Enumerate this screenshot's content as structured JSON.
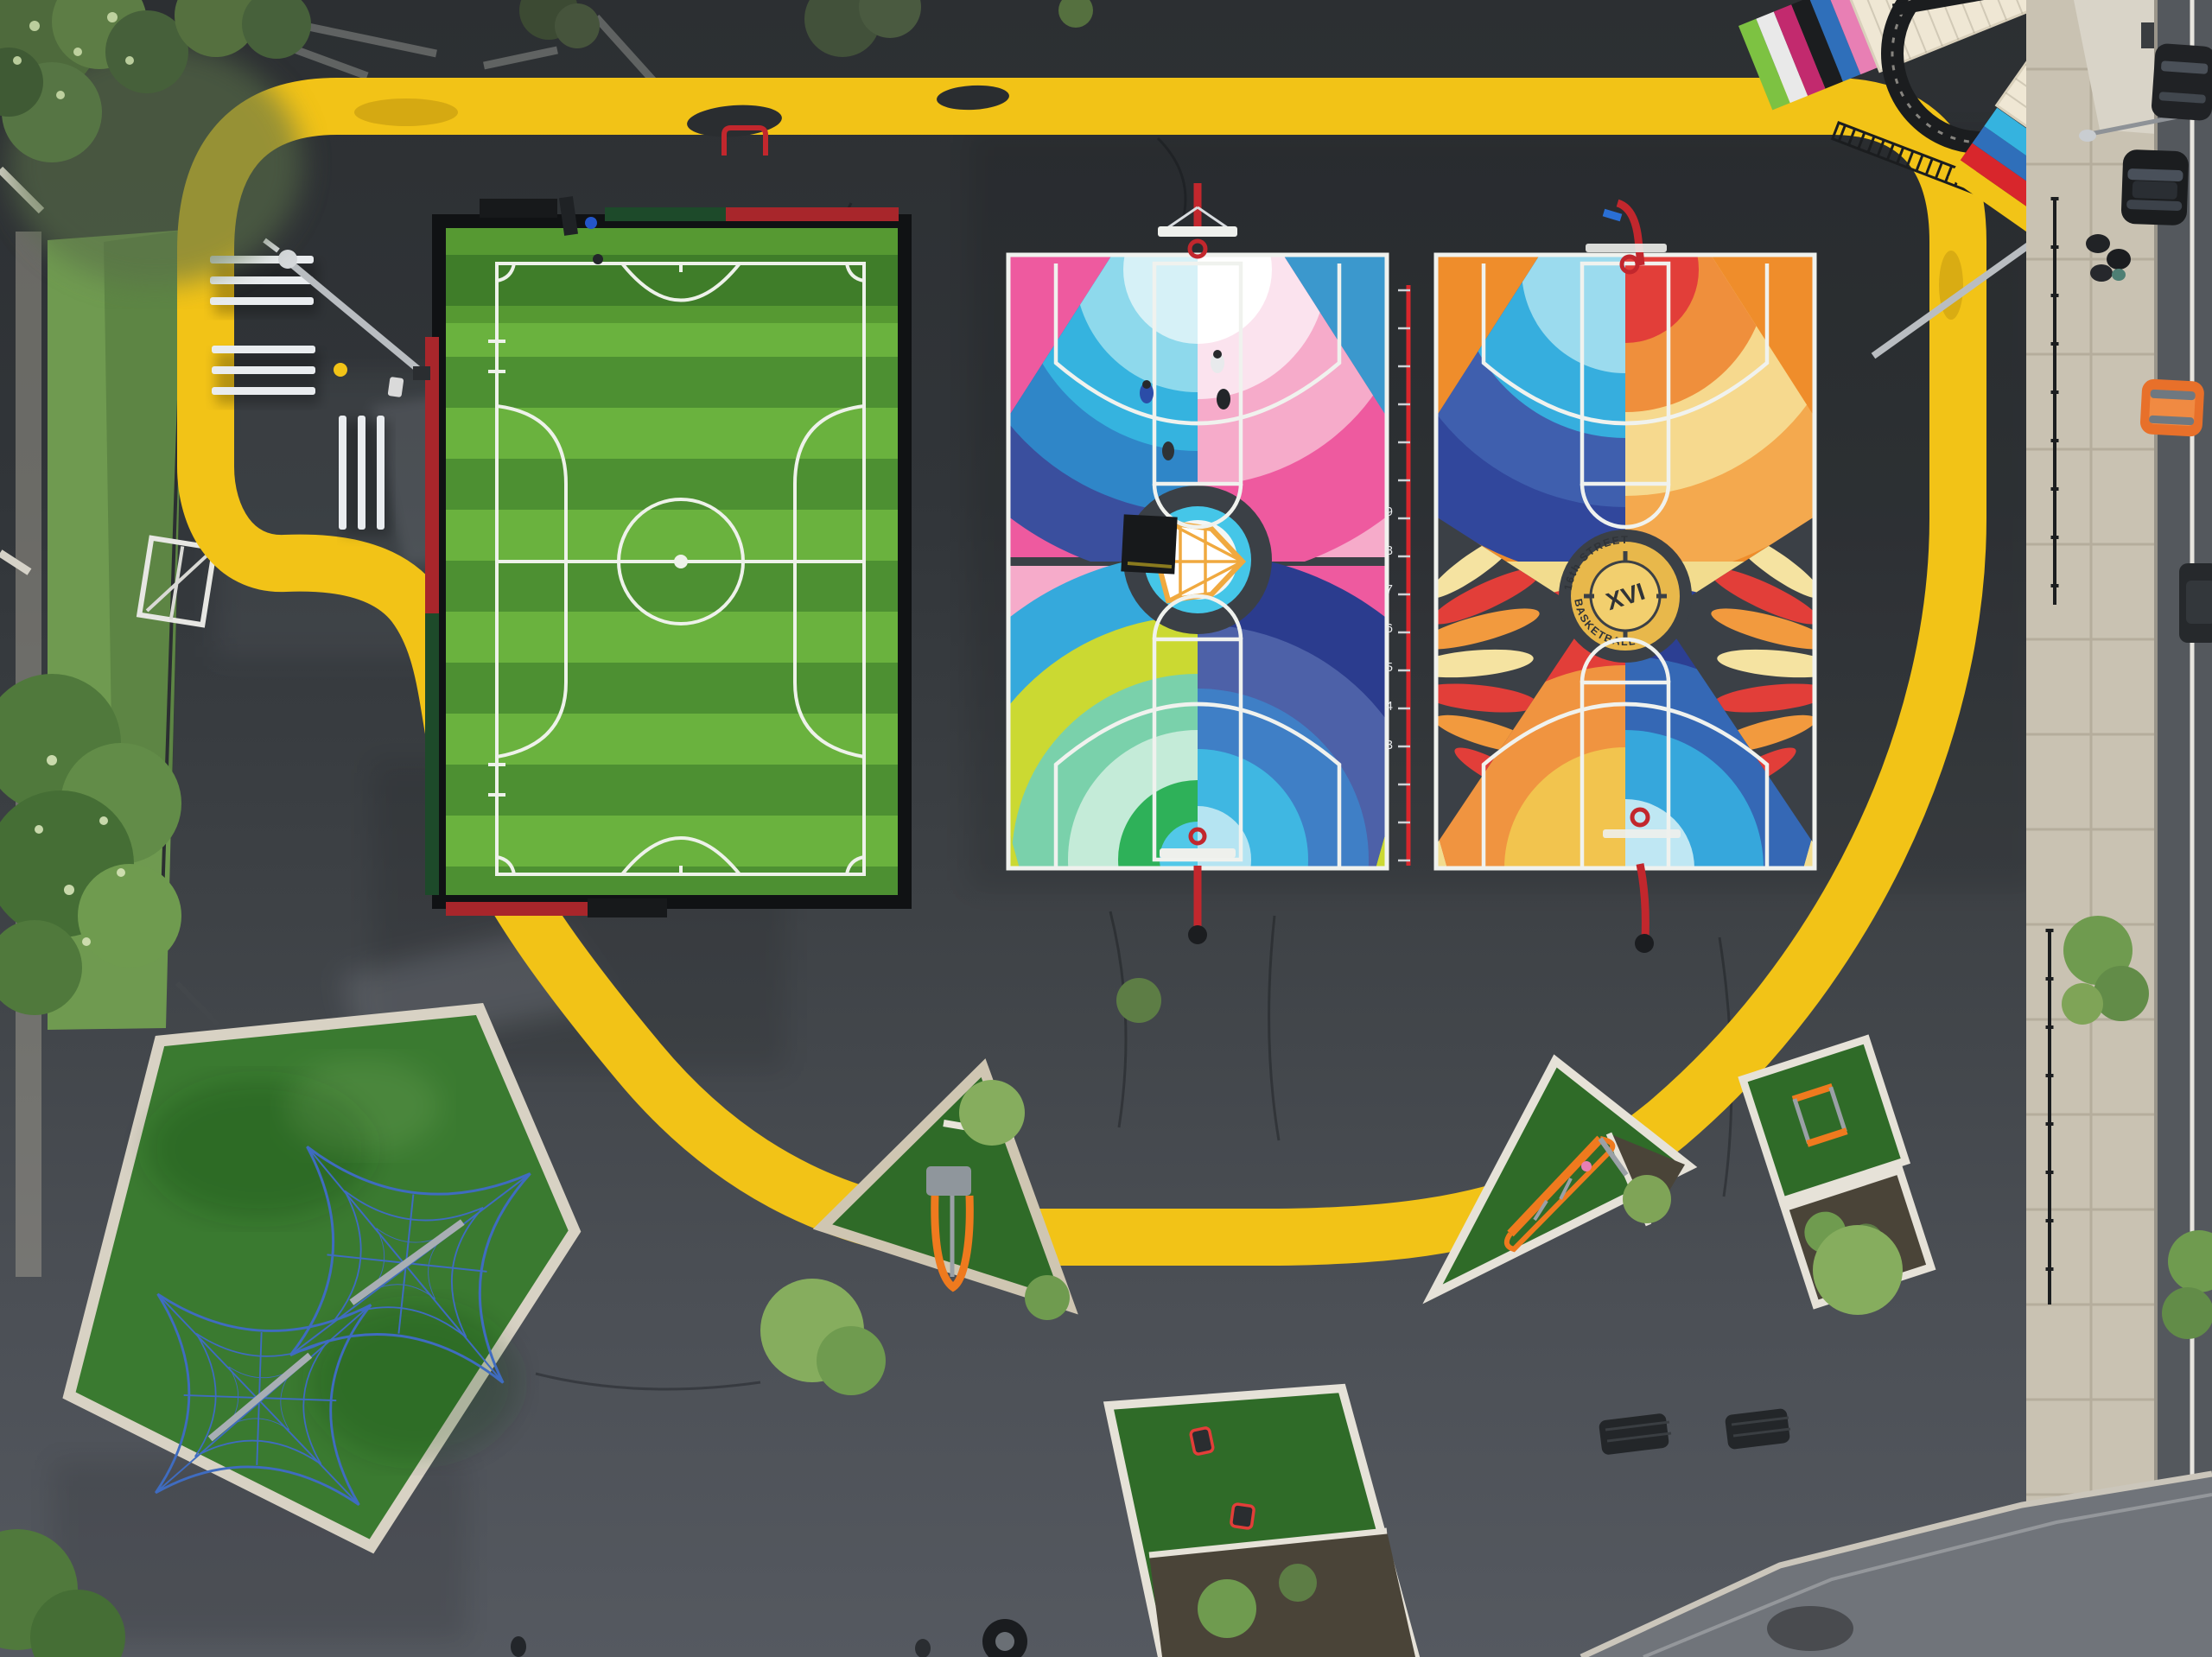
{
  "meta": {
    "title": "Aerial view of painted playground with soccer pitch, two mural basketball courts and yellow loop track"
  },
  "palette": {
    "asphalt": "#34383c",
    "track_yellow": "#f2c317",
    "field_green_light": "#6ab23e",
    "field_green_dark": "#4d9032",
    "court_pink": "#ee5a9f",
    "court_blue": "#3b98cd",
    "court_chartreuse": "#cbd932",
    "court_orange": "#ef8d2b",
    "court_cream": "#f2dc8e",
    "wing_slate": "#3b4046",
    "ruler_red": "#d8262c",
    "hoop_red": "#c2272d",
    "medallion_gold": "#e8b84b",
    "net_blue": "#3f6cc0",
    "turf_green": "#2f6b28"
  },
  "ruler": {
    "numbers": [
      "9",
      "8",
      "7",
      "6",
      "5",
      "4",
      "3"
    ]
  },
  "court_right": {
    "medallion": {
      "top_text": "16th STREET",
      "bottom_text": "BASKETBALL",
      "monogram": "XVI"
    }
  }
}
